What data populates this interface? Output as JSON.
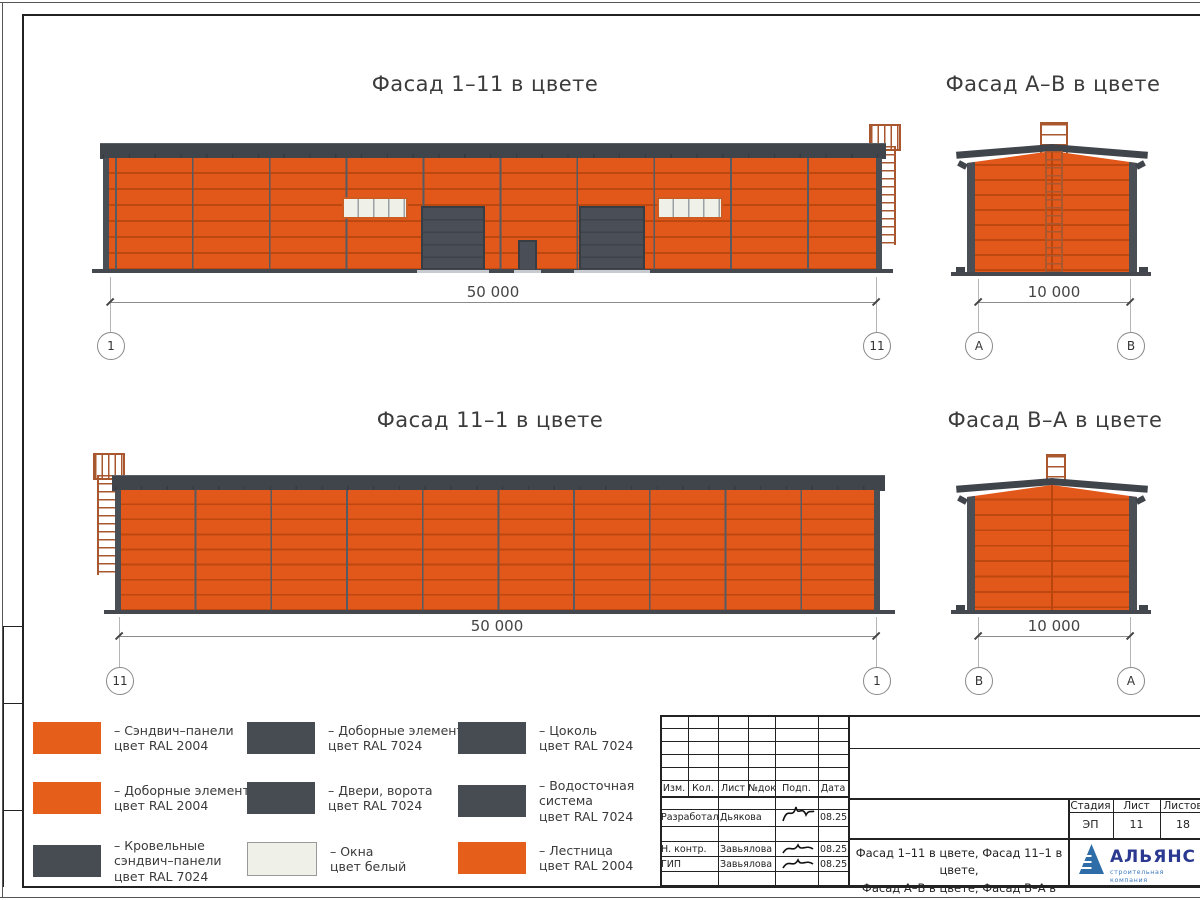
{
  "titles": {
    "f11": "Фасад 1–11 в цвете",
    "fab": "Фасад А–В в цвете",
    "f111": "Фасад 11–1 в цвете",
    "fba": "Фасад В–А в цвете"
  },
  "dims": {
    "long": "50 000",
    "short": "10 000"
  },
  "axes": {
    "f11_left": "1",
    "f11_right": "11",
    "fab_left": "А",
    "fab_right": "В",
    "f111_left": "11",
    "f111_right": "1",
    "fba_left": "В",
    "fba_right": "А"
  },
  "legend": {
    "items": [
      {
        "swatch": "#E55F1A",
        "text": "– Сэндвич–панели\nцвет RAL 2004"
      },
      {
        "swatch": "#474B52",
        "text": "– Доборные элементы\nцвет RAL 7024"
      },
      {
        "swatch": "#474B52",
        "text": "– Цоколь\nцвет RAL 7024"
      },
      {
        "swatch": "#E55F1A",
        "text": "– Доборные элементы\nцвет RAL 2004"
      },
      {
        "swatch": "#474B52",
        "text": "– Двери, ворота\nцвет RAL 7024"
      },
      {
        "swatch": "#474B52",
        "text": "– Водосточная\nсистема\nцвет RAL 7024"
      },
      {
        "swatch": "#474B52",
        "text": "– Кровельные\nсэндвич–панели\nцвет RAL 7024"
      },
      {
        "swatch": "#EFF0E7",
        "text": "– Окна\nцвет белый"
      },
      {
        "swatch": "#E55F1A",
        "text": "– Лестница\nцвет RAL 2004"
      }
    ]
  },
  "tb": {
    "cols": [
      "Изм.",
      "Кол.",
      "Лист",
      "№док",
      "Подп.",
      "Дата"
    ],
    "rows": [
      {
        "role": "Разработал",
        "name": "Дьякова",
        "date": "08.25"
      },
      {
        "role": "Н. контр.",
        "name": "Завьялова",
        "date": "08.25"
      },
      {
        "role": "ГИП",
        "name": "Завьялова",
        "date": "08.25"
      }
    ],
    "stage_headers": [
      "Стадия",
      "Лист",
      "Листов"
    ],
    "stage_values": [
      "ЭП",
      "11",
      "18"
    ],
    "sheet_name": "Фасад 1–11 в цвете, Фасад 11–1 в цвете,\nФасад А–В в цвете, Фасад В–А в цвете",
    "logo_name": "АЛЬЯНС",
    "logo_subtitle": "строительная компания"
  },
  "colors": {
    "panel_orange": "#E2571A",
    "panel_joint": "#BC470F",
    "dark_gray_ral7024": "#474B52",
    "roof_gray": "#40444B",
    "window_white": "#EFF1E9",
    "ladder_orange": "#A8572E",
    "logo_blue": "#2B3A90",
    "logo_light_blue": "#3D7ABF"
  }
}
